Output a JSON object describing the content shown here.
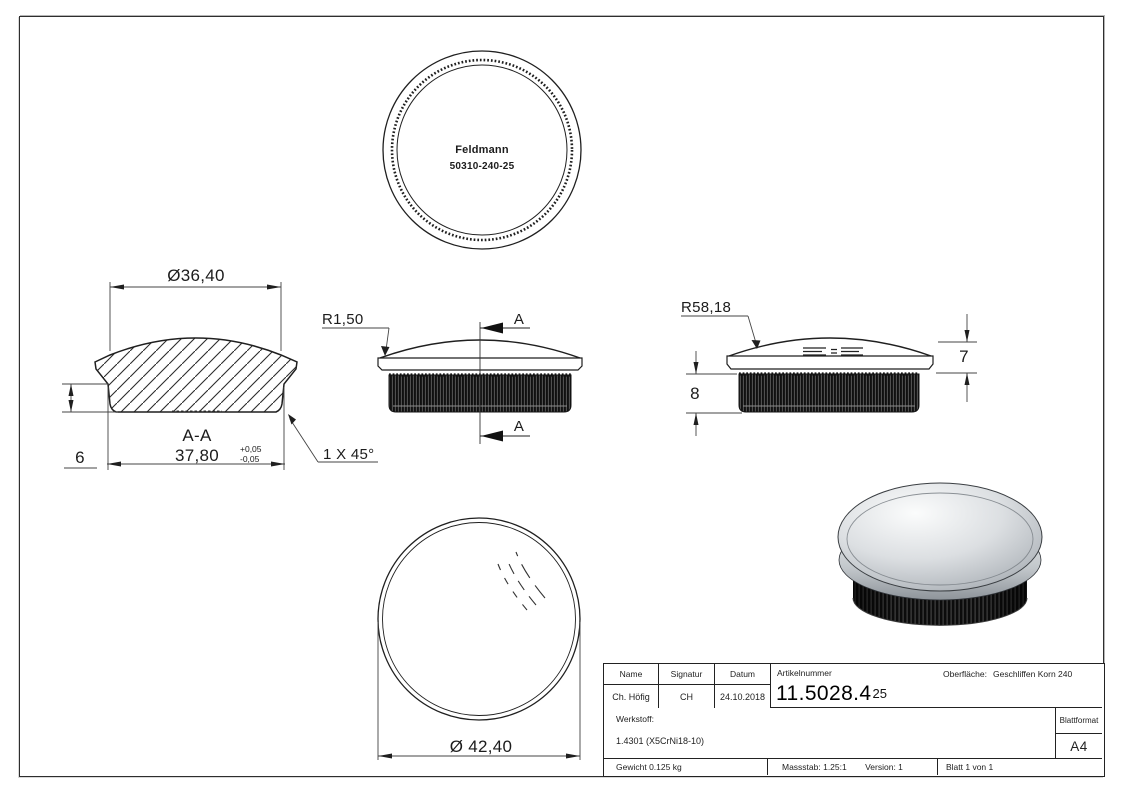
{
  "views": {
    "top": {
      "brand": "Feldmann",
      "part_number": "50310-240-25"
    },
    "section": {
      "view_label": "A-A",
      "dia_top": "Ø36,40",
      "width_bottom": "37,80",
      "tol_plus": "+0,05",
      "tol_minus": "-0,05",
      "height": "6",
      "chamfer": "1 X 45°"
    },
    "front": {
      "radius": "R1,50",
      "cut_label_top": "A",
      "cut_label_bottom": "A"
    },
    "side": {
      "radius": "R58,18",
      "cap_height": "7",
      "insert_height": "8"
    },
    "bottom": {
      "diameter": "Ø 42,40"
    }
  },
  "title_block": {
    "col_name": "Name",
    "col_signature": "Signatur",
    "col_date": "Datum",
    "article_label": "Artikelnummer",
    "article_number": "11.5028.4",
    "article_suffix": "25",
    "surface_label": "Oberfläche:",
    "surface_value": "Geschliffen Korn 240",
    "name_value": "Ch. Höfig",
    "signature_value": "CH",
    "date_value": "24.10.2018",
    "material_label": "Werkstoff:",
    "material_value": "1.4301 (X5CrNi18-10)",
    "sheet_format_label": "Blattformat",
    "sheet_format_value": "A4",
    "weight": "Gewicht 0.125 kg",
    "scale": "Massstab: 1.25:1",
    "version": "Version: 1",
    "sheet": "Blatt 1 von 1"
  },
  "colors": {
    "line": "#1f1f1f",
    "dim_line": "#444444",
    "knurl_dark": "#101010",
    "metal_light": "#fafbfb",
    "metal_mid": "#9fa4aa"
  }
}
